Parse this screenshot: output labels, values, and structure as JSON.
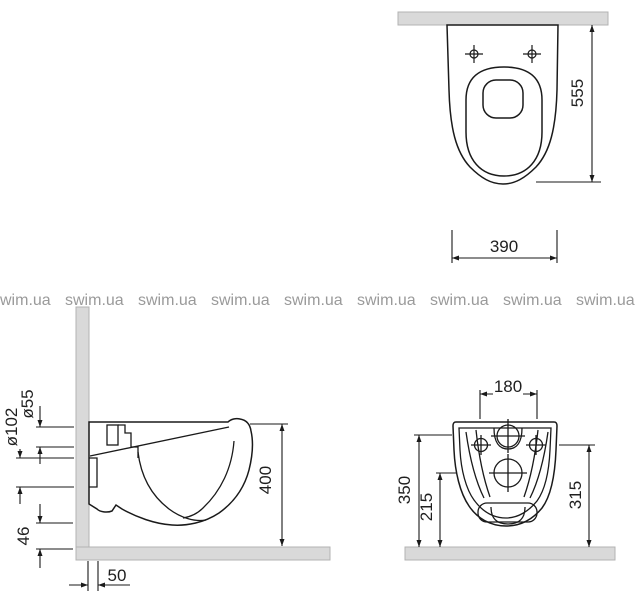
{
  "watermark": {
    "text": "swim.ua"
  },
  "top_view": {
    "depth": "555",
    "seat_width": "390"
  },
  "side_view": {
    "drain_diameter": "ø102",
    "inlet_diameter": "ø55",
    "bottom_clearance": "46",
    "height": "400",
    "wall_offset": "50"
  },
  "rear_view": {
    "bolt_spacing": "180",
    "inlet_center_height": "350",
    "drain_center_height": "215",
    "bolt_center_height": "315"
  },
  "colors": {
    "wall_fill": "#d9d9d9",
    "wall_border": "#b3b3b3",
    "line": "#1a1a1a",
    "watermark": "#9a9a9a"
  }
}
